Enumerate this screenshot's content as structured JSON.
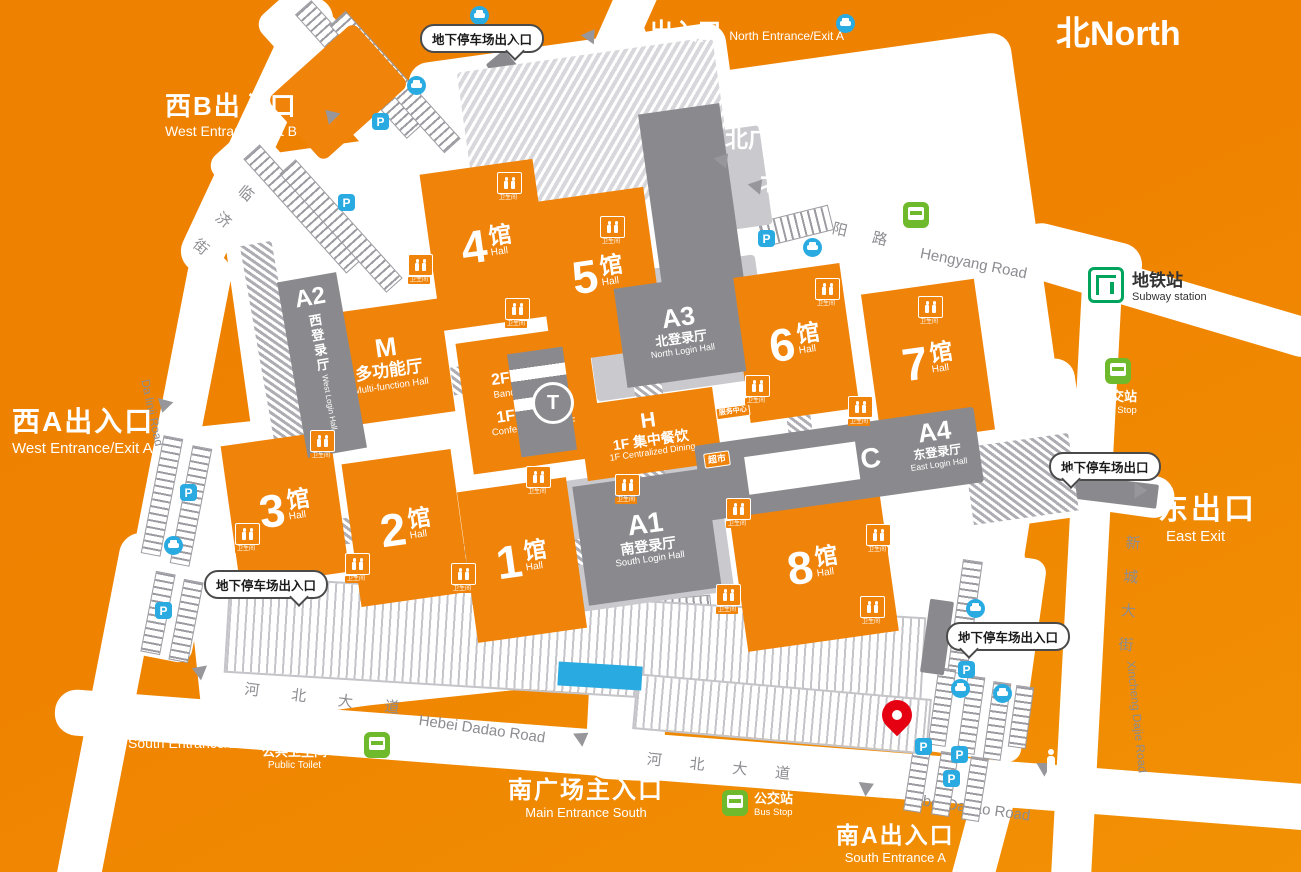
{
  "title": {
    "north_badge": "北North"
  },
  "entrances": {
    "north_a": {
      "zh": "北A出入口",
      "en": "North Entrance/Exit  A"
    },
    "main_north": {
      "zh": "北广场主入口",
      "en": "Main Entrance North"
    },
    "north_b": {
      "zh": "北B出入口",
      "en": "North Entrance/Exit B"
    },
    "west_b": {
      "zh": "西B出入口",
      "en": "West Entrance/Exit  B"
    },
    "west_a": {
      "zh": "西A出入口",
      "en": "West Entrance/Exit  A"
    },
    "east_exit": {
      "zh": "东出口",
      "en": "East Exit"
    },
    "south_b": {
      "zh": "南B出入口",
      "en": "South Entrance/Exit  B"
    },
    "main_south": {
      "zh": "南广场主入口",
      "en": "Main Entrance South"
    },
    "south_a": {
      "zh": "南A出入口",
      "en": "South Entrance A"
    }
  },
  "roads": {
    "hengyang": {
      "zh_chars": [
        "恒",
        "阳",
        "路"
      ],
      "en": "Hengyang Road"
    },
    "dalinji": {
      "zh_chars": [
        "大",
        "临",
        "济",
        "街"
      ],
      "en": "Da linji Road"
    },
    "xincheng": {
      "zh_chars": [
        "新",
        "城",
        "大",
        "街"
      ],
      "en": "Xincheng Dajie Road"
    },
    "hebei": {
      "zh_chars": [
        "河",
        "北",
        "大",
        "道"
      ],
      "en": "Hebei Dadao Road"
    }
  },
  "halls": {
    "unit": "馆",
    "en": "Hall",
    "list": [
      {
        "num": "1"
      },
      {
        "num": "2"
      },
      {
        "num": "3"
      },
      {
        "num": "4"
      },
      {
        "num": "5"
      },
      {
        "num": "6"
      },
      {
        "num": "7"
      },
      {
        "num": "8"
      }
    ]
  },
  "buildings": {
    "a1": {
      "code": "A1",
      "zh": "南登录厅",
      "en": "South Login Hall"
    },
    "a2": {
      "code": "A2",
      "zh": "西登录厅",
      "en": "West Login Hall"
    },
    "a3": {
      "code": "A3",
      "zh": "北登录厅",
      "en": "North Login Hall"
    },
    "a4": {
      "code": "A4",
      "zh": "东登录厅",
      "en": "East Login Hall"
    },
    "c": {
      "code": "C"
    },
    "m": {
      "code": "M",
      "zh": "多功能厅",
      "en": "Multi-function Hall"
    },
    "banquet": {
      "zh": "2F 宴会厅",
      "en": "Banquet Hall 2/F"
    },
    "conference": {
      "zh": "1F 会议厅",
      "en": "Conference Hall 1/F"
    },
    "dining": {
      "code": "H",
      "zh": "1F 集中餐饮",
      "en": "1F Centralized Dining"
    },
    "t_monument": {
      "code": "T"
    }
  },
  "facilities": {
    "subway": {
      "zh": "地铁站",
      "en": "Subway station",
      "icon": "subway-icon"
    },
    "bus": {
      "zh": "公交站",
      "en": "Bus Stop",
      "icon": "bus-icon"
    },
    "public_toilet": {
      "zh": "公共卫生间",
      "en": "Public Toilet",
      "icon": "toilet-figures-icon"
    },
    "toilet_tag": "卫生间",
    "supermarket": "超市",
    "service_center": "服务中心",
    "parking_letter": "P"
  },
  "callouts": {
    "parking_entrance": "地下停车场出入口",
    "parking_exit": "地下停车场出口"
  },
  "colors": {
    "background_orange": "#EF8300",
    "building_orange": "#F0830A",
    "building_gray": "#8A8A8E",
    "parking_blue": "#29ABE2",
    "bus_green": "#6FBA2C",
    "subway_green": "#00A45D",
    "pin_red": "#E60112"
  }
}
